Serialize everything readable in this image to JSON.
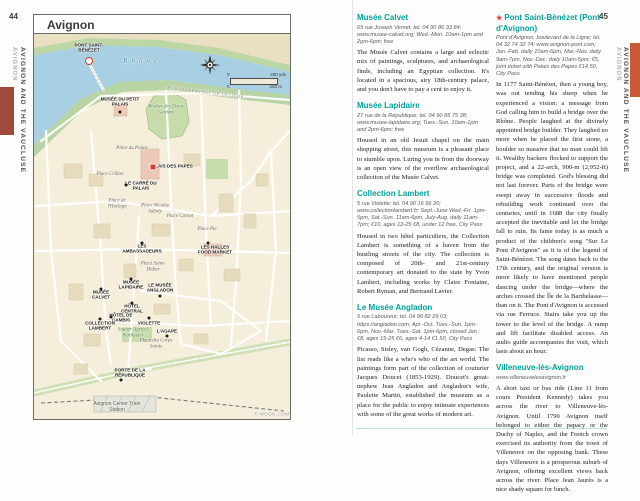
{
  "page": {
    "left_number": "44",
    "right_number": "45",
    "sidebar_section": "AVIGNON AND THE VAUCLUSE",
    "sidebar_sub": "AVIGNON",
    "tab_color_left": "#a04a3a",
    "tab_color_right": "#c75b38"
  },
  "map": {
    "title": "Avignon",
    "credit": "© MOON.COM",
    "scale": {
      "zero_top": "0",
      "top": "200 yds",
      "zero_bottom": "0",
      "bottom": "200 m"
    },
    "labels": [
      {
        "t": "PONT SAINT-BÉNÉZET",
        "type": "poi",
        "x": 88,
        "y": 47,
        "w": 50,
        "marker": "ring",
        "mx": 88,
        "my": 60
      },
      {
        "t": "Rhône",
        "type": "water",
        "x": 141,
        "y": 60,
        "w": 60
      },
      {
        "t": "MUSÉE DU PETIT PALAIS",
        "type": "poi",
        "x": 119,
        "y": 101,
        "w": 44,
        "marker": "dot",
        "mx": 119,
        "my": 111
      },
      {
        "t": "Rocher des Doms Gardens",
        "type": "park",
        "x": 165,
        "y": 109,
        "w": 38
      },
      {
        "t": "Place du Palais",
        "type": "place",
        "x": 131,
        "y": 148,
        "w": 32
      },
      {
        "t": "PALAIS DES PAPES",
        "type": "poi",
        "x": 170,
        "y": 165,
        "w": 44,
        "marker": "red",
        "mx": 152,
        "my": 166
      },
      {
        "t": "Place Crillon",
        "type": "place",
        "x": 109,
        "y": 174,
        "w": 32
      },
      {
        "t": "LE CARRÉ DU PALAIS",
        "type": "poi",
        "x": 140,
        "y": 185,
        "w": 38,
        "marker": "dot",
        "mx": 125,
        "my": 184
      },
      {
        "t": "Place de l'Horloge",
        "type": "place",
        "x": 116,
        "y": 203,
        "w": 34
      },
      {
        "t": "Place Nicolas Saboly",
        "type": "place",
        "x": 154,
        "y": 208,
        "w": 32
      },
      {
        "t": "Place Carnot",
        "type": "place",
        "x": 179,
        "y": 216,
        "w": 28
      },
      {
        "t": "Place Pie",
        "type": "place",
        "x": 206,
        "y": 229,
        "w": 26
      },
      {
        "t": "LES HALLES FOOD MARKET",
        "type": "poi",
        "x": 214,
        "y": 249,
        "w": 40,
        "marker": "dot",
        "mx": 207,
        "my": 242
      },
      {
        "t": "LES AMBASSADEURS",
        "type": "poi",
        "x": 141,
        "y": 248,
        "w": 44,
        "marker": "dot",
        "mx": 141,
        "my": 242
      },
      {
        "t": "Place Saint-Didier",
        "type": "place",
        "x": 152,
        "y": 266,
        "w": 34
      },
      {
        "t": "MUSÉE LAPIDAIRE",
        "type": "poi",
        "x": 130,
        "y": 284,
        "w": 34,
        "marker": "dot",
        "mx": 130,
        "my": 278
      },
      {
        "t": "LE MUSÉE ANGLADON",
        "type": "poi",
        "x": 159,
        "y": 287,
        "w": 38,
        "marker": "dot",
        "mx": 159,
        "my": 295
      },
      {
        "t": "MUSÉE CALVET",
        "type": "poi",
        "x": 100,
        "y": 294,
        "w": 30,
        "marker": "dot",
        "mx": 100,
        "my": 288
      },
      {
        "t": "HÔTEL CENTRAL",
        "type": "poi",
        "x": 131,
        "y": 308,
        "w": 30,
        "marker": "dot",
        "mx": 131,
        "my": 302
      },
      {
        "t": "HÔTEL DE CAMBIS",
        "type": "poi",
        "x": 120,
        "y": 317,
        "w": 30,
        "marker": "dot",
        "mx": 110,
        "my": 316
      },
      {
        "t": "COLLECTION LAMBERT",
        "type": "poi",
        "x": 99,
        "y": 325,
        "w": 38,
        "marker": "dot",
        "mx": 99,
        "my": 318
      },
      {
        "t": "VIOLETTE",
        "type": "poi",
        "x": 148,
        "y": 322,
        "w": 24,
        "marker": "dot",
        "mx": 148,
        "my": 317
      },
      {
        "t": "L'AGAPE",
        "type": "poi",
        "x": 166,
        "y": 330,
        "w": 22,
        "marker": "dot",
        "mx": 166,
        "my": 335
      },
      {
        "t": "Square Agricol Perdiguier",
        "type": "park",
        "x": 132,
        "y": 332,
        "w": 36
      },
      {
        "t": "Place des Corps Saints",
        "type": "place",
        "x": 155,
        "y": 343,
        "w": 34
      },
      {
        "t": "PORTE DE LA RÉPUBLIQUE",
        "type": "poi",
        "x": 129,
        "y": 372,
        "w": 48,
        "marker": "dot",
        "mx": 120,
        "my": 379
      },
      {
        "t": "RUE DU REMPART DE LA LIGNE",
        "type": "street",
        "x": 205,
        "y": 91,
        "w": 90,
        "rot": 7
      },
      {
        "t": "Avignon Center Train Station",
        "type": "station",
        "x": 116,
        "y": 406,
        "w": 52
      },
      {
        "t": "© MOON.COM",
        "type": "credit",
        "x": 271,
        "y": 413,
        "w": 44
      }
    ]
  },
  "articles": {
    "star_glyph": "★",
    "col1": [
      {
        "heading": "Musée Calvet",
        "details": "65 rue Joseph Vernet; tel. 04 90 86 33 84; www.musee-calvet.org; Wed.-Mon. 10am-1pm and 2pm-6pm; free",
        "body": "The Musée Calvet contains a large and eclectic mix of paintings, sculptures, and archaeological finds, including an Egyptian collection. It's located in a spacious, airy 18th-century palace, and you don't have to pay a cent to enjoy it."
      },
      {
        "heading": "Musée Lapidaire",
        "details": "27 rue de la République; tel. 04 90 85 75 38; www.musee-lapidaire.org; Tues.-Sun. 10am-1pm and 2pm-6pm; free",
        "body": "Housed in an old Jesuit chapel on the main shopping street, this museum is a pleasant place to stumble upon. Luring you in from the doorway is an open view of the overflow archaeological collection of the Musée Calvet."
      },
      {
        "heading": "Collection Lambert",
        "details": "5 rue Violette; tel. 04 90 16 56 20; www.collectionlambert.fr; Sept.-June Wed.-Fri. 1pm-5pm, Sat.-Sun. 11am-6pm, July-Aug. daily 11am-7pm; €10, ages 12-25 €8, under 12 free, City Pass",
        "body": "Housed in two hôtel particuliers, the Collection Lambert is something of a haven from the bustling streets of the city. The collection is composed of 20th- and 21st-century contemporary art donated to the state by Yvon Lambert, including works by Claire Fontaine, Robert Ryman, and Bertrand Lavier."
      },
      {
        "heading": "Le Musée Angladon",
        "details": "5 rue Laboureur; tel. 04 90 82 29 03; https://angladon.com; Apr.-Oct. Tues.-Sun. 1pm-6pm, Nov.-Mar. Tues.-Sat. 1pm-6pm, closed Jan.; €8, ages 15-25 €6, ages 4-14 €1.50, City Pass",
        "body": "Picasso, Sisley, van Gogh, Cézanne, Degas: The list reads like a who's who of the art world. The paintings form part of the collection of couturier Jacques Doucet (1853-1929). Doucet's great-nephew Jean Angladon and Angladon's wife, Paulette Martin, established the museum as a place for the public to enjoy intimate experiences with some of the great works of modern art."
      }
    ],
    "col2": [
      {
        "starred": true,
        "heading": "Pont Saint-Bénézet (Pont d'Avignon)",
        "details": "Pont d'Avignon, boulevard de la Ligne; tel. 04 32 74 32 74; www.avignon-pont.com; Jan.-Feb. daily 10am-6pm, Mar.-Nov. daily 9am-7pm, Nov.-Dec. daily 10am-5pm; €5, joint ticket with Palais des Papes €14.50, City Pass",
        "body": "In 1177 Saint-Bénézet, then a young boy, was out tending his sheep when he experienced a vision: a message from God calling him to build a bridge over the Rhône. People laughed at the divinely appointed bridge builder. They laughed no more when he placed the first stone, a boulder so massive that no man could lift it. Wealthy backers flocked to support the project, and a 22-arch, 900-m (2,952-ft) bridge was completed. God's blessing did not last forever. Parts of the bridge were swept away in successive floods and rebuilding work continued over the centuries, until in 1688 the city finally accepted the inevitable and let the bridge fall to ruin. Its fame today is as much a product of the children's song \"Sur Le Pont d'Avignon\" as it is of the legend of Saint-Bénézet. The song dates back to the 17th century, and the original version is more likely to have mentioned people dancing under the bridge—where the arches crossed the Île de la Barthelasse—than on it. The Pont d'Avignon is accessed via rue Ferruce. Stairs take you up the tower to the level of the bridge. A ramp and lift facilitate disabled access. An audio guide accompanies the visit, which lasts about an hour."
      },
      {
        "heading": "Villeneuve-lès-Avignon",
        "details": "www.villeneuvelesavignon.fr",
        "body": "A short taxi or bus ride (Line 11 from cours President Kennedy) takes you across the river to Villeneuve-lès-Avignon. Until 1790 Avignon itself belonged to either the papacy or the Duchy of Naples, and the French crown exercised its authority from the town of Villeneuve on the opposing bank. These days Villeneuve is a prosperous suburb of Avignon, offering excellent views back across the river. Place Jean Jaurès is a nice shady square for lunch."
      }
    ]
  }
}
